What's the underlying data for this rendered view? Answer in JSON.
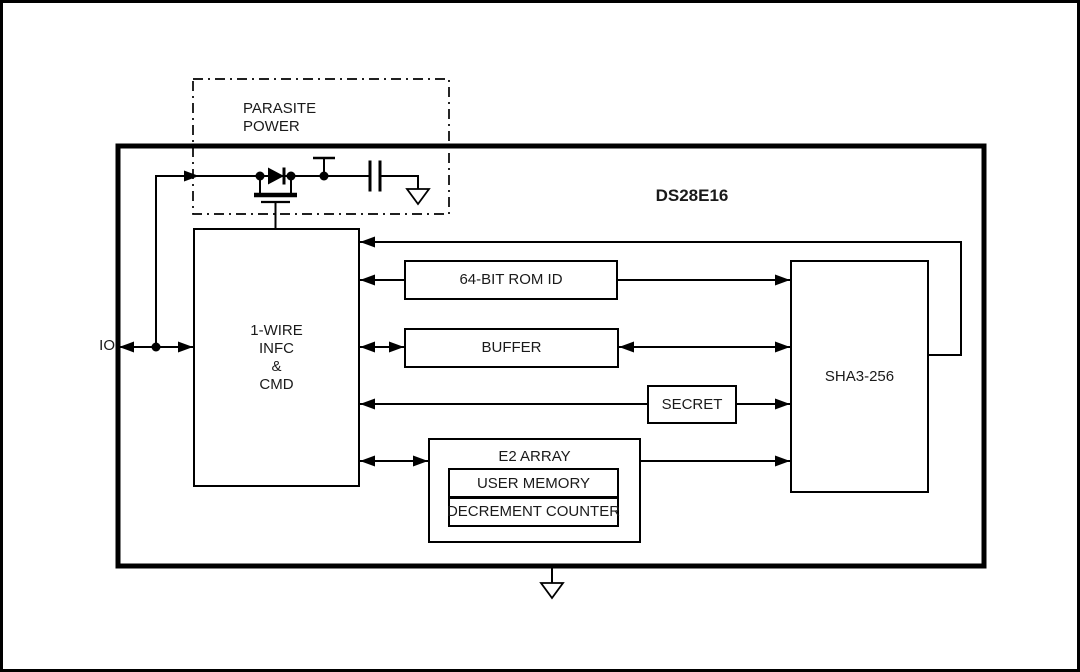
{
  "labels": {
    "title": "DS28E16",
    "io": "IO",
    "parasite_line1": "PARASITE",
    "parasite_line2": "POWER",
    "onewire_line1": "1-WIRE",
    "onewire_line2": "INFC",
    "onewire_line3": "&",
    "onewire_line4": "CMD",
    "rom": "64-BIT ROM ID",
    "buffer": "BUFFER",
    "secret": "SECRET",
    "e2_array": "E2 ARRAY",
    "user_memory": "USER MEMORY",
    "decrement_counter": "DECREMENT COUNTER",
    "sha3": "SHA3-256"
  },
  "colors": {
    "line": "#000000",
    "text": "#1a1a1a",
    "background": "#ffffff"
  }
}
